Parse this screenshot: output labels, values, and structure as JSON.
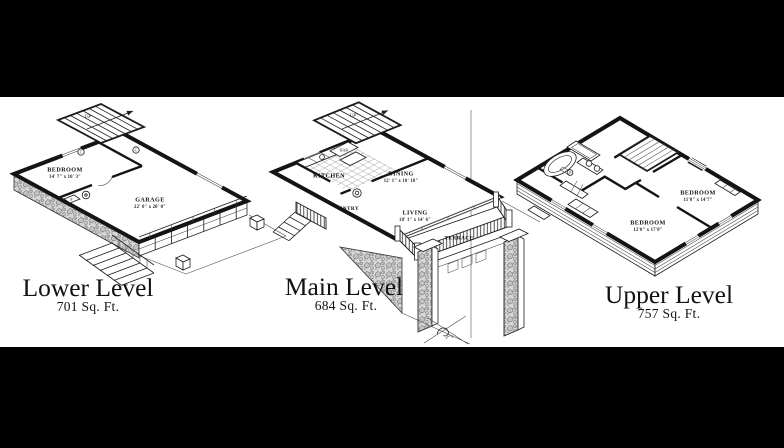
{
  "colors": {
    "background": "#000000",
    "canvas": "#ffffff",
    "ink": "#141414"
  },
  "plans": {
    "lower": {
      "title": "Lower Level",
      "area": "701 Sq. Ft.",
      "stair_label": "UP",
      "rooms": {
        "bedroom": {
          "name": "BEDROOM",
          "dims": "14' 7\" x 10' 3\""
        },
        "garage": {
          "name": "GARAGE",
          "dims": "22' 0\" x 20' 0\""
        }
      },
      "fixtures": {
        "c1": "C",
        "c2": "C",
        "f": "F"
      }
    },
    "main": {
      "title": "Main Level",
      "area": "684 Sq. Ft.",
      "stair_label": "UP",
      "rooms": {
        "kitchen": {
          "name": "KITCHEN"
        },
        "dining": {
          "name": "DINING",
          "dims": "12' 1\" x 10' 10\""
        },
        "living": {
          "name": "LIVING",
          "dims": "18' 1\" x 14' 6\""
        },
        "entry": {
          "name": "ENTRY"
        },
        "terrace": {
          "name": "TERRACE"
        },
        "bar": {
          "name": "BAR"
        }
      }
    },
    "upper": {
      "title": "Upper Level",
      "area": "757 Sq. Ft.",
      "rooms": {
        "bedroom_right": {
          "name": "BEDROOM",
          "dims": "11'0\" x 14'7\""
        },
        "bedroom_left": {
          "name": "BEDROOM",
          "dims": "12'0\" x 17'0\""
        }
      }
    }
  }
}
